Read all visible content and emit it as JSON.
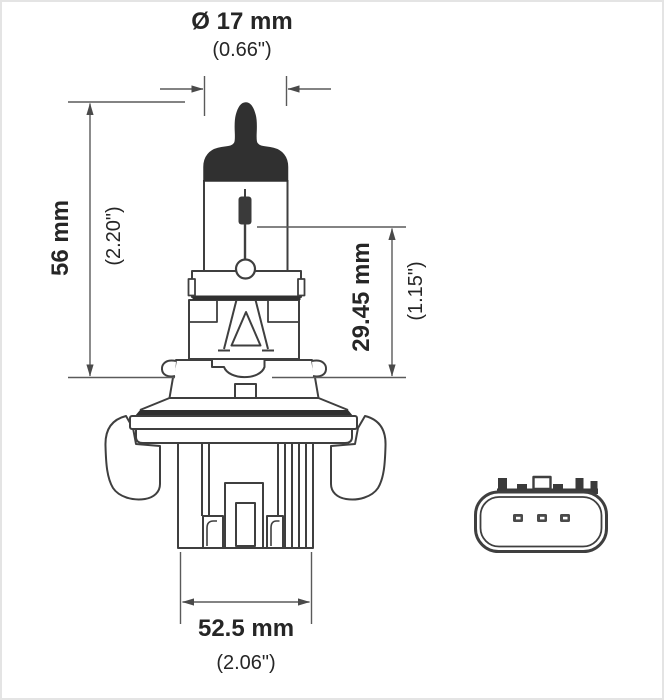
{
  "diagram": {
    "kind": "technical-dimension-drawing",
    "subject": "H13 halogen headlight bulb, side view with plug connector face view",
    "colors": {
      "background": "#ffffff",
      "outline": "#3f3f3f",
      "dark_fill": "#303030",
      "dimension_line": "#5a5a5a",
      "text": "#262626",
      "frame_border": "#e4e4e4"
    },
    "labels": {
      "diameter_mm": "Ø 17 mm",
      "diameter_in": "(0.66\")",
      "length_mm": "56 mm",
      "length_in": "(2.20\")",
      "filament_mm": "29.45 mm",
      "filament_in": "(1.15\")",
      "width_mm": "52.5 mm",
      "width_in": "(2.06\")"
    }
  }
}
